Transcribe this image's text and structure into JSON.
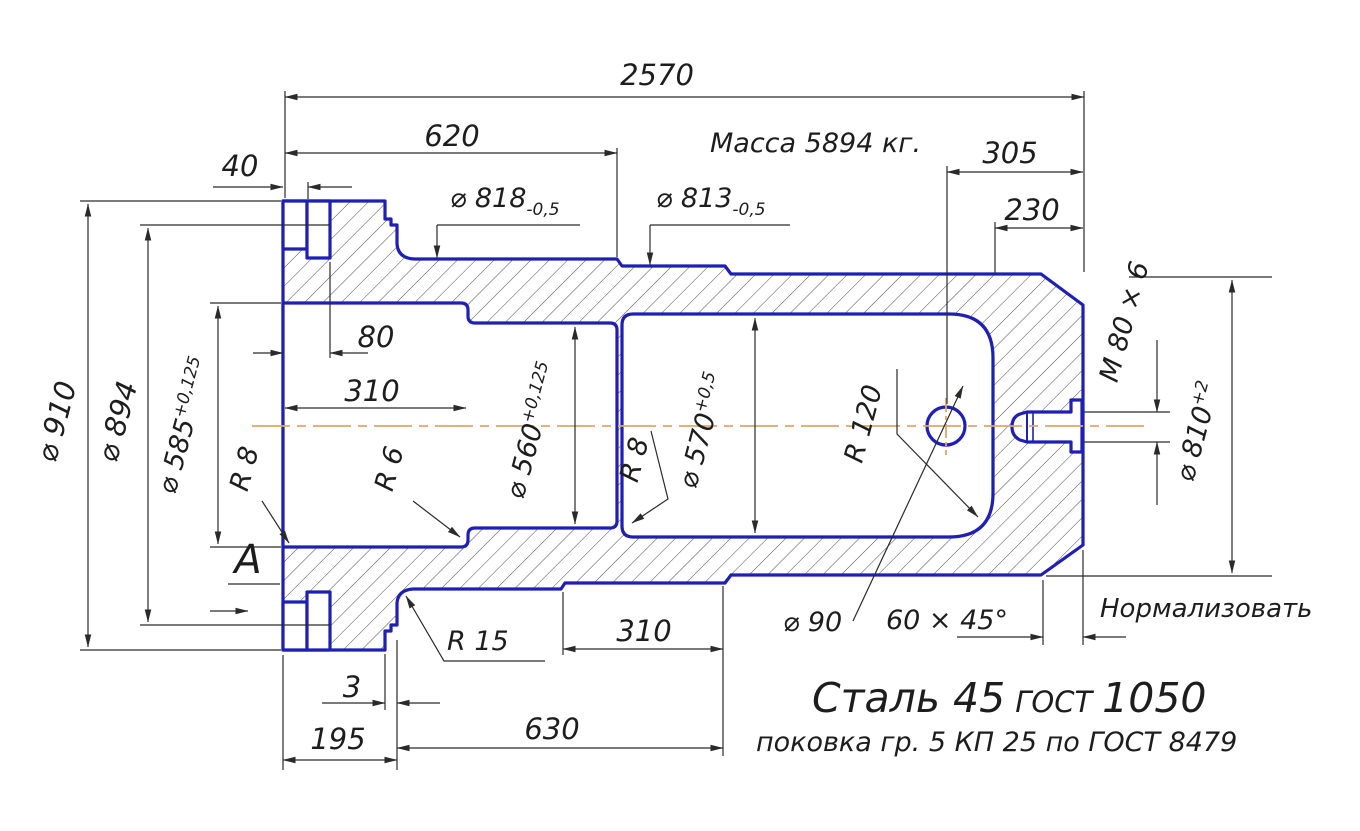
{
  "drawing_notes": {
    "mass": "Масса 5894 кг.",
    "heat_treatment": "Нормализовать",
    "material_name": "Сталь 45",
    "material_gost": "ГОСТ",
    "material_gost_num": "1050",
    "forging_spec": "поковка гр. 5 КП 25 по ГОСТ 8479",
    "view_label": "А"
  },
  "dimensions": {
    "overall_2570": "2570",
    "len_620": "620",
    "len_40": "40",
    "len_305": "305",
    "len_230": "230",
    "len_80": "80",
    "bore_depth_310": "310",
    "len_310": "310",
    "len_630": "630",
    "len_195": "195",
    "len_3": "3",
    "dia_818": "⌀ 818",
    "dia_818_tol": "-0,5",
    "dia_813": "⌀ 813",
    "dia_813_tol": "-0,5",
    "dia_910": "⌀ 910",
    "dia_894": "⌀ 894",
    "dia_585": "⌀ 585",
    "dia_585_tol": "+0,125",
    "dia_560": "⌀ 560",
    "dia_560_tol": "+0,125",
    "dia_570": "⌀ 570",
    "dia_570_tol": "+0,5",
    "dia_810": "⌀ 810",
    "dia_810_tol": "+2",
    "thread": "M 80 × 6",
    "radius_r8_left": "R 8",
    "radius_r6": "R 6",
    "radius_r8_mid": "R 8",
    "radius_r120": "R 120",
    "radius_r15": "R 15",
    "dia_90": "⌀ 90",
    "chamfer": "60 × 45°"
  },
  "colors": {
    "outline": "#1f1fb4",
    "dim": "#2a2a2a",
    "centerline": "#e0a865",
    "hatch": "#4d4d4d"
  }
}
